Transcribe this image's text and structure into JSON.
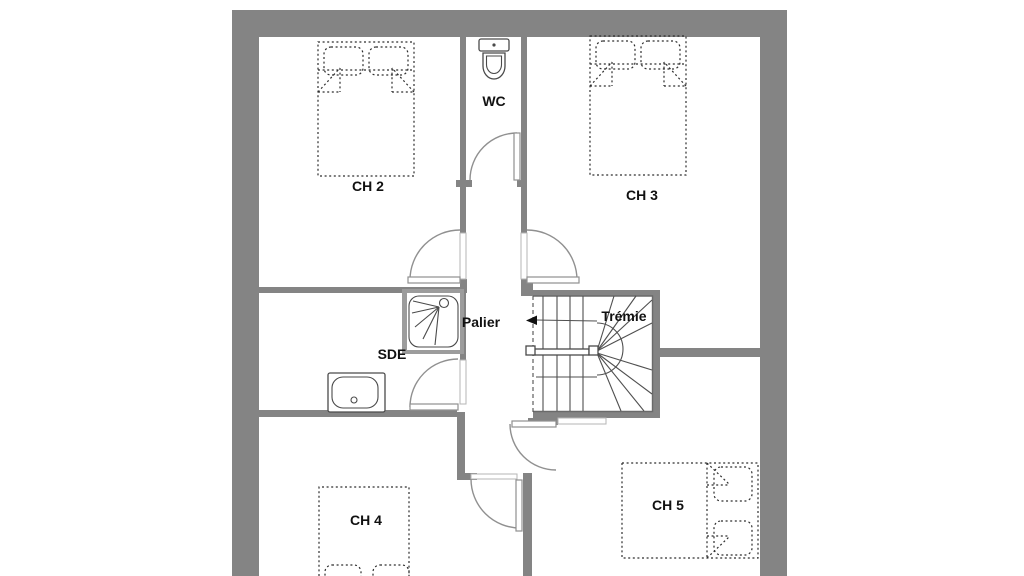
{
  "app": {
    "type": "architectural-floor-plan",
    "background": "#ffffff"
  },
  "colors": {
    "wall": "#848484",
    "door": "#909090",
    "fixture": "#4a4a4a",
    "stair": "#4f4f4f",
    "bed": "#2e2e2e",
    "label": "#111111"
  },
  "rooms": {
    "ch2": {
      "label": "CH 2"
    },
    "wc": {
      "label": "WC"
    },
    "ch3": {
      "label": "CH 3"
    },
    "sde": {
      "label": "SDE"
    },
    "palier": {
      "label": "Palier"
    },
    "tremie": {
      "label": "Trémie"
    },
    "ch4": {
      "label": "CH 4"
    },
    "ch5": {
      "label": "CH 5"
    }
  }
}
